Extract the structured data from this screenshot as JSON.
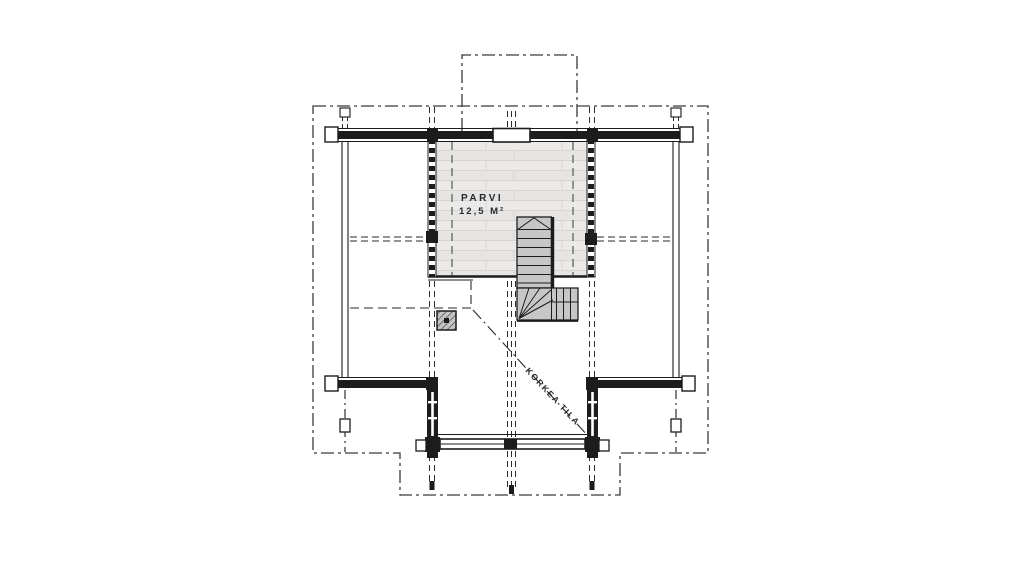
{
  "plan": {
    "loft": {
      "name": "PARVI",
      "area": "12,5 M²"
    },
    "open_space": {
      "label": "KORKEA TILA"
    }
  },
  "colors": {
    "background": "#ffffff",
    "line": "#1c1c1c",
    "outline_dashdot": "#3a3a3a",
    "loft_floor_fill": "#eae9e7",
    "stair_fill": "#c7c7c7",
    "chimney_fill": "#c4c4c4"
  }
}
